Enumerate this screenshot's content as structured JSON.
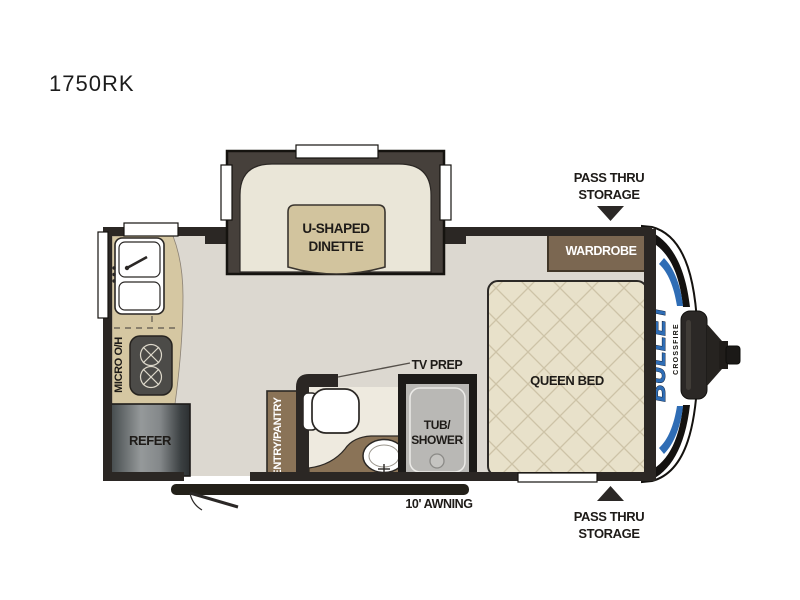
{
  "title": "1750RK",
  "brand": {
    "name": "BULLET",
    "series": "CROSSFIRE"
  },
  "labels": {
    "dinette_1": "U-SHAPED",
    "dinette_2": "DINETTE",
    "queen_bed": "QUEEN BED",
    "wardrobe": "WARDROBE",
    "refer": "REFER",
    "micro_oh": "MICRO O/H",
    "entry_pantry": "ENTRY/PANTRY",
    "tub_1": "TUB/",
    "tub_2": "SHOWER",
    "tv_prep": "TV PREP",
    "awning": "10' AWNING",
    "pass_thru_1": "PASS THRU",
    "pass_thru_2": "STORAGE"
  },
  "colors": {
    "floor": "#dcd8d0",
    "bath_floor": "#eeeadf",
    "wall": "#2b2724",
    "slide_wall": "#46403b",
    "counter": "#d5c7a2",
    "cushion": "#eae6d8",
    "table": "#d2c49e",
    "bed": "#e8e1ca",
    "bed_lattice": "#cdc3a7",
    "wood": "#8a7357",
    "wardrobe": "#7b6751",
    "tub": "#b9b8b5",
    "appliance": "#4c4b48",
    "accent_blue": "#2f6db5",
    "label": "#1e1b18"
  }
}
